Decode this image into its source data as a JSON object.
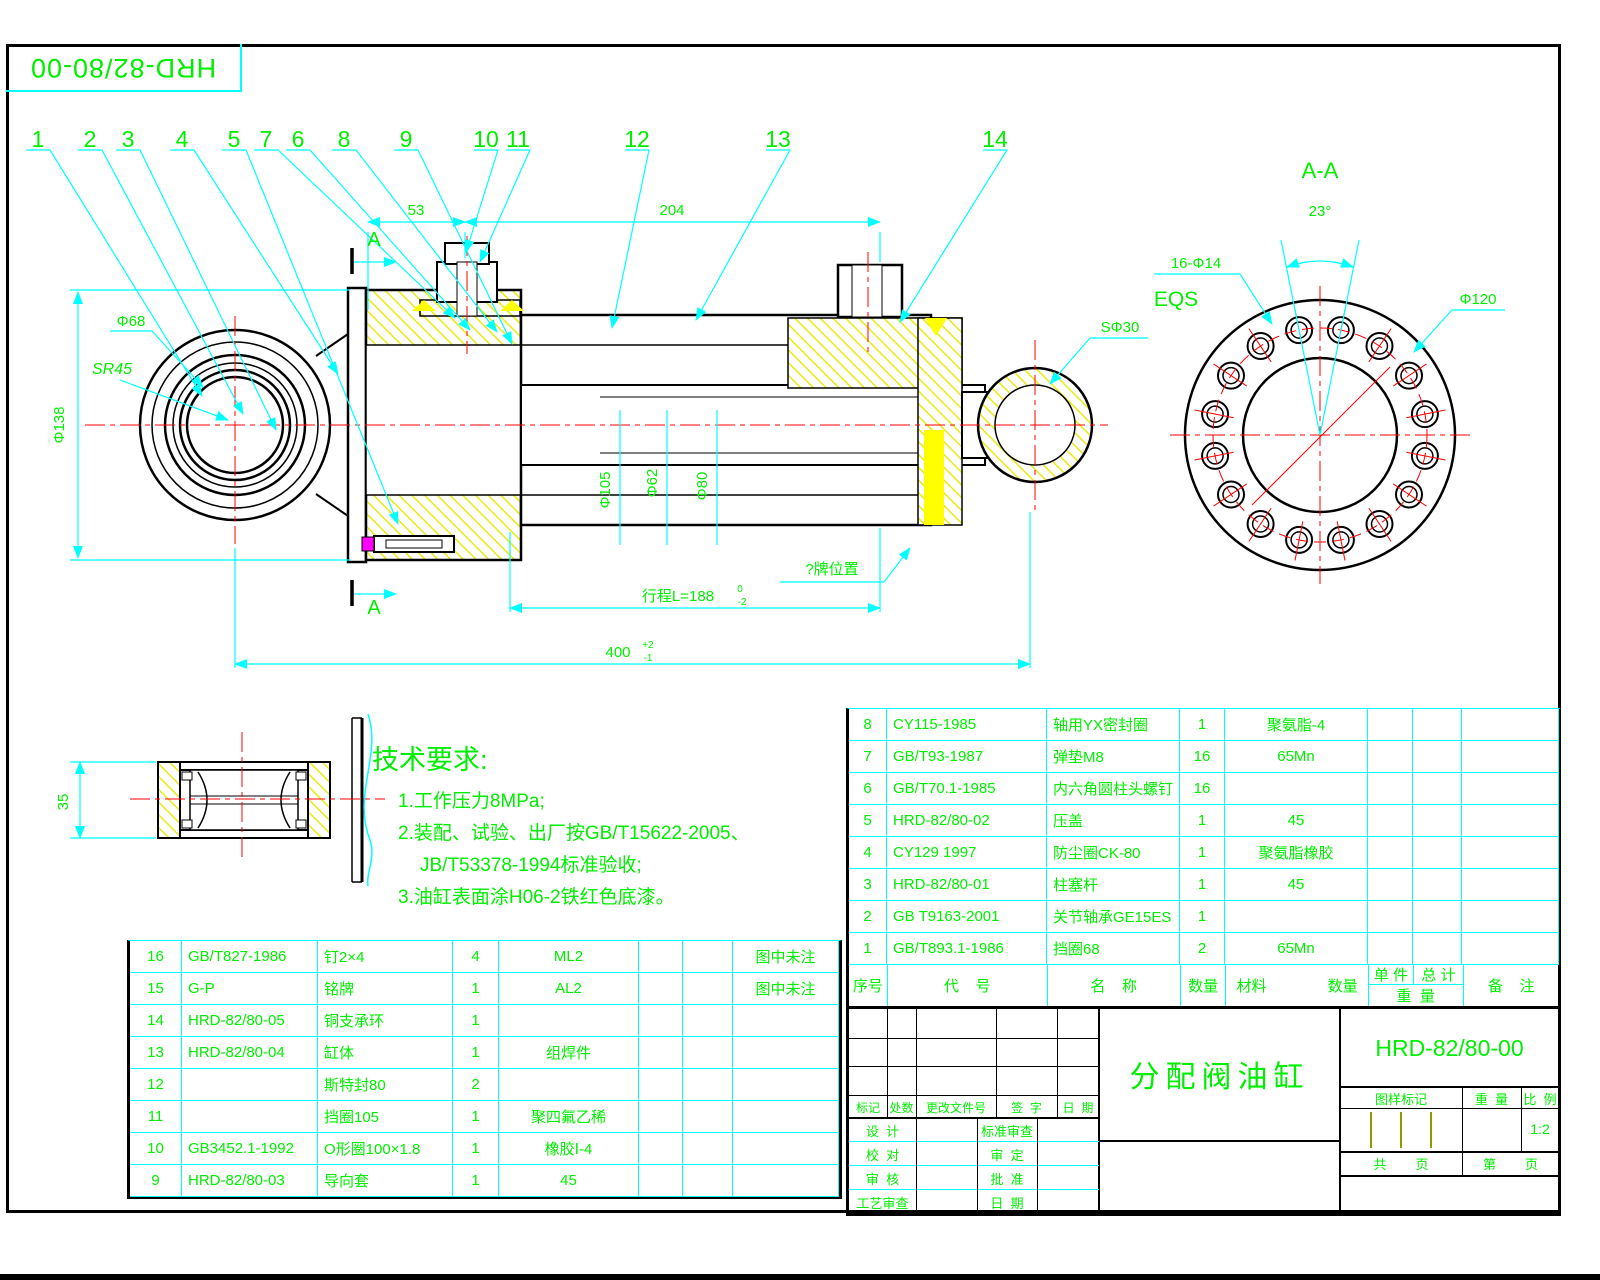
{
  "sheet": {
    "doc_number_box": "HRD-82/80-00",
    "accent_green": "#00ee00",
    "line_cyan": "#00ffff",
    "line_red": "#ff0000",
    "hatch_yellow": "#ffff00"
  },
  "callouts": [
    "1",
    "2",
    "3",
    "4",
    "5",
    "7",
    "6",
    "8",
    "9",
    "10",
    "11",
    "12",
    "13",
    "14"
  ],
  "dims": {
    "d53": "53",
    "d204": "204",
    "section_a_top": "A",
    "section_a_bottom": "A",
    "phi68": "Φ68",
    "sr45": "SR45",
    "phi138": "Φ138",
    "phi105": "Φ105",
    "phi62": "Φ62",
    "phi80": "Φ80",
    "sphi30": "SΦ30",
    "nameplate_note": "?牌位置",
    "stroke_label": "行程L=188",
    "stroke_tol_top": "0",
    "stroke_tol_bottom": "-2",
    "d400": "400",
    "d400_tol_top": "+2",
    "d400_tol_bottom": "-1",
    "d35": "35"
  },
  "section_aa": {
    "title": "A-A",
    "angle": "23°",
    "holes": "16-Φ14",
    "eqs": "EQS",
    "phi120": "Φ120"
  },
  "tech_req": {
    "title": "技术要求:",
    "line1": "1.工作压力8MPa;",
    "line2": "2.装配、试验、出厂按GB/T15622-2005、",
    "line3": "JB/T53378-1994标准验收;",
    "line4": "3.油缸表面涂H06-2铁红色底漆。"
  },
  "bom_left": {
    "rows": [
      {
        "no": "16",
        "code": "GB/T827-1986",
        "name": "钉2×4",
        "qty": "4",
        "material": "ML2",
        "remark": "图中未注"
      },
      {
        "no": "15",
        "code": "G-P",
        "name": "铭牌",
        "qty": "1",
        "material": "AL2",
        "remark": "图中未注"
      },
      {
        "no": "14",
        "code": "HRD-82/80-05",
        "name": "铜支承环",
        "qty": "1",
        "material": "",
        "remark": ""
      },
      {
        "no": "13",
        "code": "HRD-82/80-04",
        "name": "缸体",
        "qty": "1",
        "material": "组焊件",
        "remark": ""
      },
      {
        "no": "12",
        "code": "",
        "name": "斯特封80",
        "qty": "2",
        "material": "",
        "remark": ""
      },
      {
        "no": "11",
        "code": "",
        "name": "挡圈105",
        "qty": "1",
        "material": "聚四氟乙稀",
        "remark": ""
      },
      {
        "no": "10",
        "code": "GB3452.1-1992",
        "name": "O形圈100×1.8",
        "qty": "1",
        "material": "橡胶Ⅰ-4",
        "remark": ""
      },
      {
        "no": "9",
        "code": "HRD-82/80-03",
        "name": "导向套",
        "qty": "1",
        "material": "45",
        "remark": ""
      }
    ]
  },
  "bom_right": {
    "header": {
      "no": "序号",
      "code": "代    号",
      "name": "名    称",
      "qty": "数量",
      "material": "材料",
      "qty2": "数量",
      "unit": "单 件",
      "total": "总 计",
      "weight": "重  量",
      "remark": "备    注"
    },
    "rows": [
      {
        "no": "8",
        "code": "CY115-1985",
        "name": "轴用YX密封圈",
        "qty": "1",
        "material": "聚氨脂-4"
      },
      {
        "no": "7",
        "code": "GB/T93-1987",
        "name": "弹垫M8",
        "qty": "16",
        "material": "65Mn"
      },
      {
        "no": "6",
        "code": "GB/T70.1-1985",
        "name": "内六角圆柱头螺钉",
        "qty": "16",
        "material": ""
      },
      {
        "no": "5",
        "code": "HRD-82/80-02",
        "name": "压盖",
        "qty": "1",
        "material": "45"
      },
      {
        "no": "4",
        "code": "CY129 1997",
        "name": "防尘圈CK-80",
        "qty": "1",
        "material": "聚氨脂橡胶"
      },
      {
        "no": "3",
        "code": "HRD-82/80-01",
        "name": "柱塞杆",
        "qty": "1",
        "material": "45"
      },
      {
        "no": "2",
        "code": "GB T9163-2001",
        "name": "关节轴承GE15ES",
        "qty": "1",
        "material": ""
      },
      {
        "no": "1",
        "code": "GB/T893.1-1986",
        "name": "挡圈68",
        "qty": "2",
        "material": "65Mn"
      }
    ]
  },
  "title_block": {
    "product_name": "分配阀油缸",
    "drawing_no": "HRD-82/80-00",
    "mark_label": "图样标记",
    "weight_label": "重  量",
    "scale_label": "比  例",
    "scale_value": "1:2",
    "pages_total": "共        页",
    "pages_no": "第        页",
    "rev": {
      "mark": "标记",
      "count": "处数",
      "doc_no": "更改文件号",
      "sign": "签  字",
      "date": "日  期"
    },
    "sig": {
      "design": "设  计",
      "std_check": "标准审查",
      "proof": "校  对",
      "approve_check": "审  定",
      "review": "审  核",
      "ratify": "批  准",
      "process": "工艺审查",
      "date": "日  期"
    }
  }
}
